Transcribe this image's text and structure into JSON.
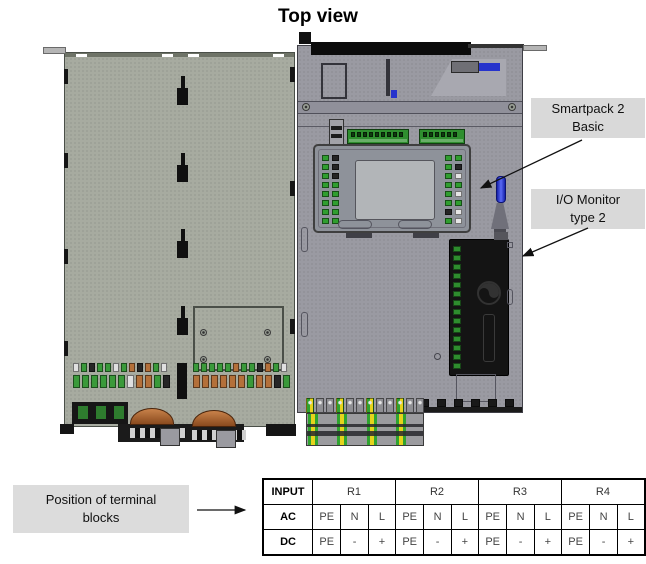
{
  "title": "Top view",
  "callouts": {
    "smartpack": {
      "line1": "Smartpack 2",
      "line2": "Basic"
    },
    "io_monitor": {
      "line1": "I/O Monitor",
      "line2": "type 2"
    },
    "terminal_position": {
      "line1": "Position of terminal",
      "line2": "blocks"
    }
  },
  "table": {
    "corner": "INPUT",
    "groups": [
      "R1",
      "R2",
      "R3",
      "R4"
    ],
    "rows": [
      {
        "label": "AC",
        "cells": [
          "PE",
          "N",
          "L",
          "PE",
          "N",
          "L",
          "PE",
          "N",
          "L",
          "PE",
          "N",
          "L"
        ]
      },
      {
        "label": "DC",
        "cells": [
          "PE",
          "-",
          "+",
          "PE",
          "-",
          "+",
          "PE",
          "-",
          "+",
          "PE",
          "-",
          "+"
        ]
      }
    ]
  },
  "palette": {
    "page_bg": "#ffffff",
    "panel_left": "#a7aba0",
    "panel_right": "#9a9aa2",
    "callout_bg": "#d9d9d9",
    "green_button": "#2f9e2f",
    "terminal_green": "#3a9a3a",
    "copper": "#b4703a",
    "pe_green": "#2fa32f",
    "pe_yellow": "#e6d31c",
    "display_gray": "#b2b5b8",
    "antenna_blue": "#2633cc",
    "black": "#111111"
  },
  "diagram": {
    "smartpack": {
      "left_col1": [
        "#2f9e2f",
        "#2f9e2f",
        "#2f9e2f",
        "#2f9e2f",
        "#2f9e2f",
        "#2f9e2f",
        "#2f9e2f",
        "#2f9e2f"
      ],
      "left_col2": [
        "#252525",
        "#252525",
        "#252525",
        "#2f9e2f",
        "#2f9e2f",
        "#2f9e2f",
        "#2f9e2f",
        "#2f9e2f"
      ],
      "right_col1": [
        "#2f9e2f",
        "#2f9e2f",
        "#2f9e2f",
        "#2f9e2f",
        "#2f9e2f",
        "#2f9e2f",
        "#252525",
        "#2f9e2f"
      ],
      "right_col2": [
        "#2f9e2f",
        "#252525",
        "#e6e6e6",
        "#2f9e2f",
        "#e6e6e6",
        "#2f9e2f",
        "#e6e6e6",
        "#e6e6e6"
      ],
      "strip1_slots": [
        "#0e3c0e",
        "#0e3c0e",
        "#0e3c0e",
        "#0e3c0e",
        "#0e3c0e",
        "#0e3c0e",
        "#0e3c0e",
        "#0e3c0e",
        "#0e3c0e"
      ],
      "strip2_slots": [
        "#0e3c0e",
        "#0e3c0e",
        "#0e3c0e",
        "#0e3c0e",
        "#0e3c0e",
        "#0e3c0e"
      ]
    },
    "left_panel": {
      "groupA_top": [
        "#e0e0e0",
        "#3a9a3a",
        "#262626",
        "#3a9a3a",
        "#3a9a3a",
        "#e0e0e0",
        "#3a9a3a",
        "#b4703a",
        "#262626",
        "#b4703a",
        "#3a9a3a",
        "#e0e0e0"
      ],
      "groupA_bottom": [
        "#3a9a3a",
        "#3a9a3a",
        "#3a9a3a",
        "#3a9a3a",
        "#3a9a3a",
        "#3a9a3a",
        "#e0e0e0",
        "#b4703a",
        "#b4703a",
        "#3a9a3a",
        "#262626"
      ],
      "groupB_top": [
        "#3a9a3a",
        "#3a9a3a",
        "#3a9a3a",
        "#3a9a3a",
        "#3a9a3a",
        "#b4703a",
        "#3a9a3a",
        "#3a9a3a",
        "#262626",
        "#b4703a",
        "#3a9a3a",
        "#e0e0e0"
      ],
      "groupB_bottom": [
        "#b4703a",
        "#b4703a",
        "#b4703a",
        "#b4703a",
        "#b4703a",
        "#b4703a",
        "#3a9a3a",
        "#b4703a",
        "#b4703a",
        "#262626",
        "#3a9a3a"
      ]
    },
    "io_monitor": {
      "terminals": [
        "#2e8c2e",
        "#2e8c2e",
        "#2e8c2e",
        "#2e8c2e",
        "#2e8c2e",
        "#2e8c2e",
        "#2e8c2e",
        "#2e8c2e",
        "#2e8c2e",
        "#2e8c2e",
        "#2e8c2e",
        "#2e8c2e",
        "#2e8c2e",
        "#2e8c2e"
      ]
    },
    "din": {
      "clamps": [
        "radial-gradient(circle at 50% 28%, #e6e6e6 1.3px, rgba(0,0,0,0) 2.2px), linear-gradient(90deg,#2fa32f 50%,#e6d31c 50%)",
        "radial-gradient(circle at 50% 28%, #e6e6e6 1.3px, rgba(0,0,0,0) 2.2px), linear-gradient(90deg,#8f8f94,#8f8f94)",
        "radial-gradient(circle at 50% 28%, #e6e6e6 1.3px, rgba(0,0,0,0) 2.2px), linear-gradient(90deg,#8f8f94,#8f8f94)",
        "radial-gradient(circle at 50% 28%, #e6e6e6 1.3px, rgba(0,0,0,0) 2.2px), linear-gradient(90deg,#2fa32f 50%,#e6d31c 50%)",
        "radial-gradient(circle at 50% 28%, #e6e6e6 1.3px, rgba(0,0,0,0) 2.2px), linear-gradient(90deg,#8f8f94,#8f8f94)",
        "radial-gradient(circle at 50% 28%, #e6e6e6 1.3px, rgba(0,0,0,0) 2.2px), linear-gradient(90deg,#8f8f94,#8f8f94)",
        "radial-gradient(circle at 50% 28%, #e6e6e6 1.3px, rgba(0,0,0,0) 2.2px), linear-gradient(90deg,#2fa32f 50%,#e6d31c 50%)",
        "radial-gradient(circle at 50% 28%, #e6e6e6 1.3px, rgba(0,0,0,0) 2.2px), linear-gradient(90deg,#8f8f94,#8f8f94)",
        "radial-gradient(circle at 50% 28%, #e6e6e6 1.3px, rgba(0,0,0,0) 2.2px), linear-gradient(90deg,#8f8f94,#8f8f94)",
        "radial-gradient(circle at 50% 28%, #e6e6e6 1.3px, rgba(0,0,0,0) 2.2px), linear-gradient(90deg,#2fa32f 50%,#e6d31c 50%)",
        "radial-gradient(circle at 50% 28%, #e6e6e6 1.3px, rgba(0,0,0,0) 2.2px), linear-gradient(90deg,#8f8f94,#8f8f94)",
        "radial-gradient(circle at 50% 28%, #e6e6e6 1.3px, rgba(0,0,0,0) 2.2px), linear-gradient(90deg,#8f8f94,#8f8f94)"
      ]
    },
    "notch_teeth": [
      "#191919",
      "#191919",
      "#191919",
      "#191919",
      "#191919",
      "#191919"
    ]
  }
}
